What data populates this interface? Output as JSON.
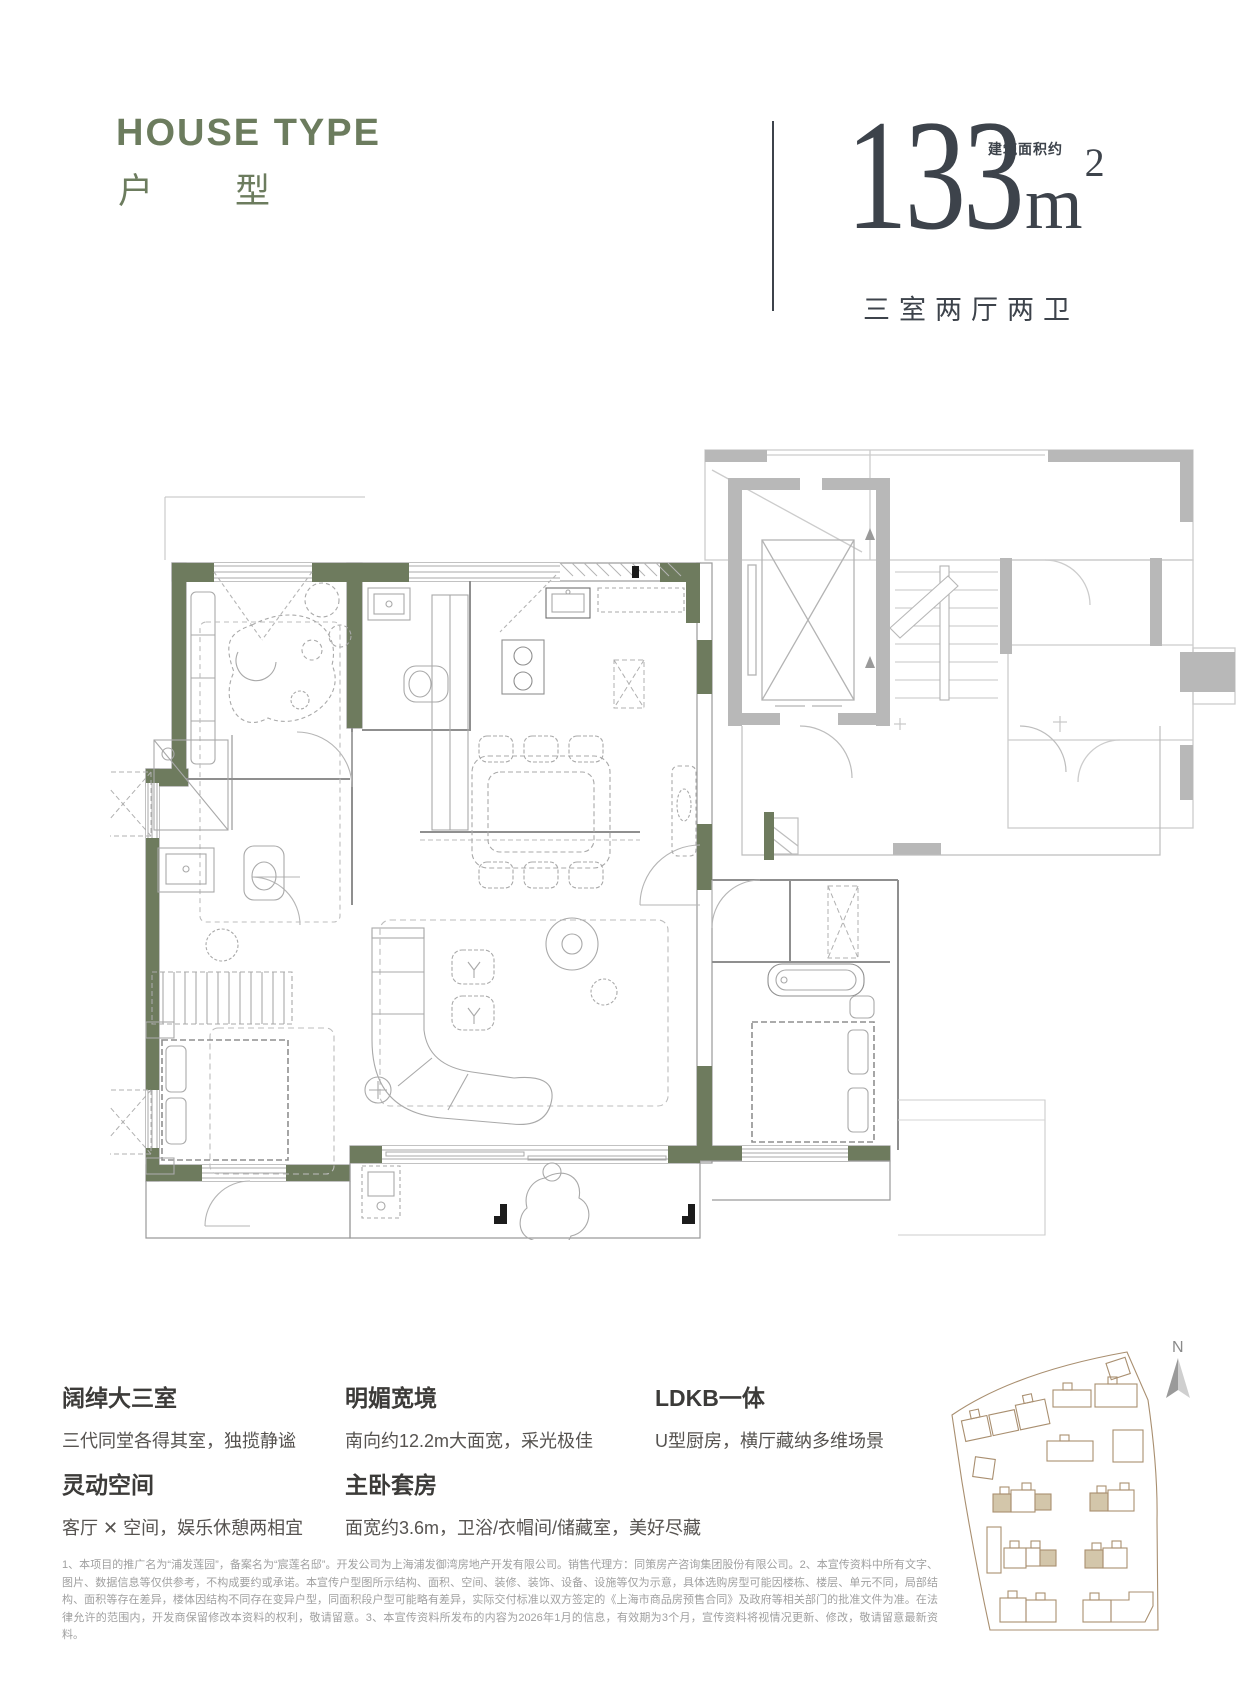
{
  "header": {
    "title_en": "HOUSE TYPE",
    "title_cn_char1": "户",
    "title_cn_char2": "型",
    "area_value": "133",
    "area_unit": "m",
    "area_sup": "2",
    "area_label": "建筑面积约",
    "layout_label": "三室两厅两卫"
  },
  "features": [
    {
      "title": "阔绰大三室",
      "desc": "三代同堂各得其室，独揽静谧"
    },
    {
      "title": "明媚宽境",
      "desc": "南向约12.2m大面宽，采光极佳"
    },
    {
      "title": "LDKB一体",
      "desc": "U型厨房，横厅藏纳多维场景"
    },
    {
      "title": "灵动空间",
      "desc": "客厅 ✕ 空间，娱乐休憩两相宜"
    },
    {
      "title": "主卧套房",
      "desc": "面宽约3.6m，卫浴/衣帽间/储藏室，美好尽藏"
    }
  ],
  "compass": {
    "label": "N"
  },
  "disclaimer": "1、本项目的推广名为“浦发莲园”，备案名为“宸莲名邸”。开发公司为上海浦发御湾房地产开发有限公司。销售代理方：同策房产咨询集团股份有限公司。2、本宣传资料中所有文字、图片、数据信息等仅供参考，不构成要约或承诺。本宣传户型图所示结构、面积、空间、装修、装饰、设备、设施等仅为示意，具体选购房型可能因楼栋、楼层、单元不同，局部结构、面积等存在差异，楼体因结构不同存在变异户型，同面积段户型可能略有差异，实际交付标准以双方签定的《上海市商品房预售合同》及政府等相关部门的批准文件为准。在法律允许的范围内，开发商保留修改本资料的权利，敬请留意。3、本宣传资料所发布的内容为2026年1月的信息，有效期为3个月，宣传资料将视情况更新、修改，敬请留意最新资料。",
  "colors": {
    "brand_green": "#6c7c5e",
    "wall_green": "#6e7b5e",
    "dark_ink": "#3d434b",
    "core_gray": "#b8b8b8",
    "site_brown": "#a98f70",
    "site_beige": "#d3c6aa"
  }
}
